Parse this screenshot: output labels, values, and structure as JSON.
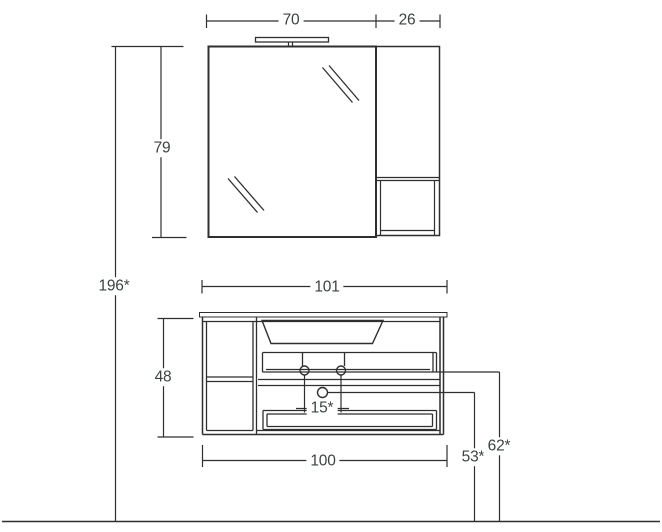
{
  "drawing": {
    "description": "Technical dimension drawing of bathroom furniture: mirror cabinet with lamp and side cabinet above a vanity unit with washbasin, side shelf unit, two drawers and round knobs, standing on a floor line",
    "labels": {
      "mirror_width": "70",
      "side_cabinet_width": "26",
      "mirror_height": "79",
      "total_height": "196*",
      "vanity_top_width": "101",
      "vanity_body_height": "48",
      "knob_spacing": "15*",
      "vanity_bottom_width": "100",
      "height_to_lower_knob": "53*",
      "height_to_upper_knobs": "62*"
    },
    "colors": {
      "line": "#2f2f2f",
      "dim_text": "#3a433e",
      "mirror_fill": "#ebebeb",
      "countertop_fill": "#3e3e3e",
      "knob_fill": "#e8862c",
      "knob_stroke": "#a3580f"
    }
  }
}
